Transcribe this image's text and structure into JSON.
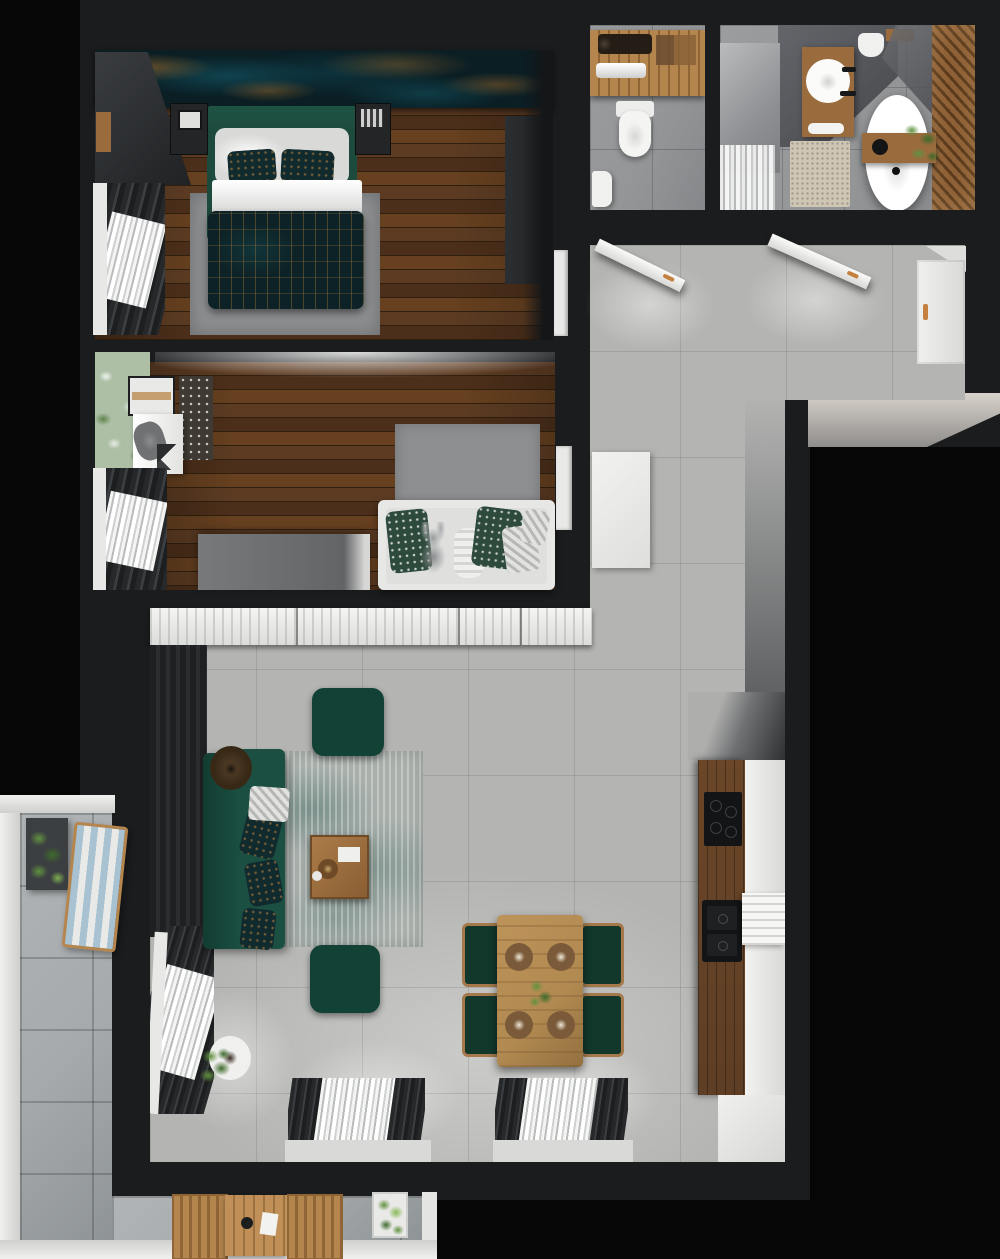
{
  "scene": {
    "title": "apartment-floor-plan-top-view",
    "type": "photorealistic-3d-floor-plan-render",
    "text_content": "none — image contains no rendered text"
  },
  "palette": {
    "outside": "#060607",
    "wall": "#1a1c1e",
    "wallLight": "#2b2e30",
    "white": "#e8e8e6",
    "concrete": "#b4b5b2",
    "stone": "#a6aaac",
    "woodA": "#5c3b22",
    "woodB": "#4c2f1a",
    "plankLine": "#31200f",
    "wallpaperBase": "#0a1e24",
    "wallpaperTeal": "#156070",
    "wallpaperGold": "#a26b2b",
    "bedGreen": "#1c4a3c",
    "pillowDark": "#112a2e",
    "duvetDark": "#0d2226",
    "duvetGold": "#96713c",
    "rugGray": "#8d8f91",
    "sofaGreen": "#1a4f42",
    "rugLiving": "#a9b0ac",
    "rugTeal": "#5e7d76",
    "poufGreen": "#124136",
    "coffeeWood": "#9c6f3f",
    "oakTable": "#b18a51",
    "chairGreen": "#12382c",
    "kitchenWood": "#5e3e24",
    "appliance": "#131416",
    "cabinetWhite": "#e9e9e8",
    "vanityWood": "#9a6b3c",
    "slatA": "#8a5c33",
    "slatB": "#553517",
    "bathFloor": "#939597",
    "bathShade": "#5b5d60",
    "rugBeige": "#cfc6b6",
    "curtain": "#26282a",
    "sheer": "#e6e7e6",
    "plant": "#61913f",
    "plantDark": "#3e6b2b",
    "deckBlue": "#a9c2d2",
    "deckWood": "#b5854e",
    "copper": "#c4803c",
    "grayWallFace": "#9c9d9b",
    "wardrobeDark": "#26282b",
    "wardrobeGray": "#707274",
    "floral": "#adbfa5",
    "toiletWhite": "#f2f2f0"
  },
  "rooms": [
    {
      "id": "master-bedroom",
      "features": [
        "double-bed",
        "white-pillows",
        "patterned-duvet",
        "nightstands",
        "corner-wardrobe",
        "dark-wardrobe",
        "gray-rug",
        "window-curtains",
        "teal-gold-wallpaper",
        "door"
      ]
    },
    {
      "id": "kids-bedroom",
      "features": [
        "daybed-with-toys",
        "desk",
        "desk-chair",
        "bookcase",
        "pattern-panel",
        "gray-wardrobe",
        "gray-rug",
        "floral-wall",
        "window-curtains",
        "door"
      ]
    },
    {
      "id": "wc",
      "features": [
        "wood-counter",
        "trough-sink",
        "towel-rolls",
        "toilet",
        "corner-washbasin"
      ]
    },
    {
      "id": "bathroom",
      "features": [
        "shower",
        "round-sink-vanity",
        "towel",
        "toilet",
        "mirror",
        "freestanding-bathtub",
        "bath-caddy",
        "plant",
        "beige-rug",
        "wood-slat-wall"
      ]
    },
    {
      "id": "hallway",
      "features": [
        "wc-door-open",
        "bathroom-door-open",
        "entrance-door",
        "white-cabinet",
        "concrete-tile-floor"
      ]
    },
    {
      "id": "living-room-kitchen",
      "features": [
        "sideboard-row",
        "corner-sofa",
        "pendant-lamp",
        "coffee-table",
        "pouf-top",
        "pouf-bottom",
        "distressed-rug",
        "dining-table",
        "four-dining-chairs",
        "place-settings",
        "kitchen-tall-unit",
        "kitchen-counter",
        "cooktop",
        "double-sink",
        "white-worktop",
        "two-windows",
        "potted-plant",
        "curtains"
      ]
    },
    {
      "id": "balcony",
      "features": [
        "stone-tile-floor",
        "planter-box",
        "striped-deck-chair",
        "outdoor-table",
        "two-outdoor-chairs",
        "planter",
        "white-parapet"
      ]
    }
  ]
}
